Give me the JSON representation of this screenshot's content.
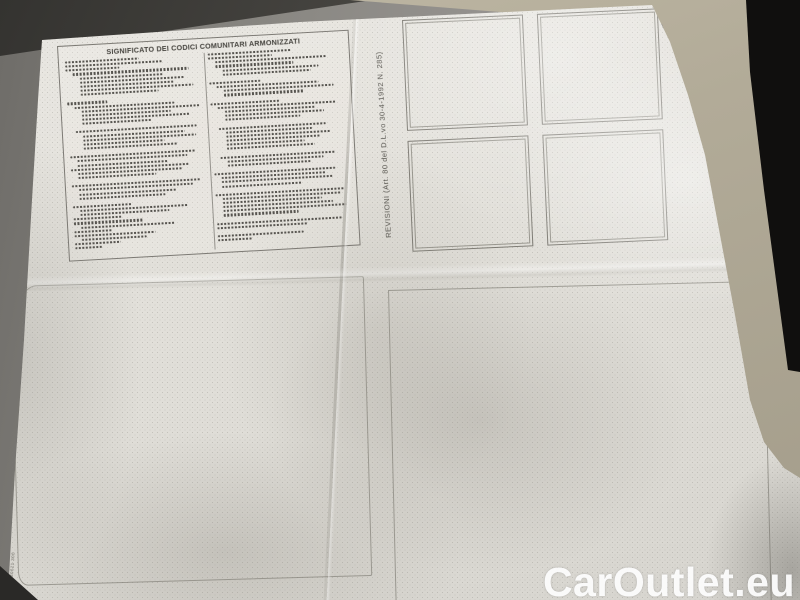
{
  "photo": {
    "watermark_text": "CarOutlet.eu"
  },
  "document": {
    "legend": {
      "title": "SIGNIFICATO DEI CODICI COMUNITARI ARMONIZZATI",
      "left_lines": [
        [
          0,
          55
        ],
        [
          0,
          72
        ],
        [
          0,
          40
        ],
        [
          1,
          86
        ],
        [
          2,
          62
        ],
        [
          2,
          78
        ],
        [
          2,
          70
        ],
        [
          2,
          84
        ],
        [
          2,
          58
        ],
        [
          0,
          0
        ],
        [
          0,
          30
        ],
        [
          1,
          74
        ],
        [
          2,
          88
        ],
        [
          2,
          66
        ],
        [
          2,
          80
        ],
        [
          2,
          52
        ],
        [
          0,
          0
        ],
        [
          1,
          90
        ],
        [
          2,
          76
        ],
        [
          2,
          84
        ],
        [
          2,
          60
        ],
        [
          2,
          70
        ],
        [
          0,
          0
        ],
        [
          0,
          94
        ],
        [
          1,
          82
        ],
        [
          1,
          68
        ],
        [
          0,
          88
        ],
        [
          1,
          77
        ],
        [
          1,
          58
        ],
        [
          0,
          0
        ],
        [
          0,
          96
        ],
        [
          1,
          85
        ],
        [
          1,
          72
        ],
        [
          1,
          64
        ],
        [
          0,
          0
        ],
        [
          0,
          44
        ],
        [
          1,
          80
        ],
        [
          1,
          66
        ],
        [
          0,
          36
        ],
        [
          0,
          52
        ],
        [
          1,
          70
        ],
        [
          0,
          28
        ],
        [
          0,
          60
        ],
        [
          1,
          48
        ],
        [
          0,
          34
        ],
        [
          0,
          20
        ]
      ],
      "right_lines": [
        [
          0,
          62
        ],
        [
          0,
          48
        ],
        [
          1,
          84
        ],
        [
          1,
          58
        ],
        [
          2,
          72
        ],
        [
          2,
          66
        ],
        [
          0,
          0
        ],
        [
          0,
          38
        ],
        [
          1,
          76
        ],
        [
          2,
          82
        ],
        [
          2,
          60
        ],
        [
          0,
          0
        ],
        [
          0,
          52
        ],
        [
          1,
          88
        ],
        [
          2,
          68
        ],
        [
          2,
          74
        ],
        [
          2,
          56
        ],
        [
          0,
          0
        ],
        [
          1,
          80
        ],
        [
          2,
          64
        ],
        [
          2,
          78
        ],
        [
          2,
          70
        ],
        [
          2,
          58
        ],
        [
          2,
          66
        ],
        [
          0,
          0
        ],
        [
          1,
          86
        ],
        [
          2,
          72
        ],
        [
          2,
          62
        ],
        [
          0,
          0
        ],
        [
          0,
          90
        ],
        [
          1,
          78
        ],
        [
          1,
          84
        ],
        [
          1,
          60
        ],
        [
          0,
          0
        ],
        [
          0,
          96
        ],
        [
          1,
          88
        ],
        [
          1,
          74
        ],
        [
          1,
          82
        ],
        [
          1,
          92
        ],
        [
          1,
          56
        ],
        [
          0,
          0
        ],
        [
          0,
          93
        ],
        [
          0,
          68
        ],
        [
          0,
          0
        ],
        [
          0,
          64
        ],
        [
          0,
          26
        ]
      ]
    },
    "revisioni": {
      "label": "REVISIONI  (Art. 80 del D.L.vo 30-4-1992 N. 285)",
      "stamp_boxes": 4
    },
    "edge_code": "A13 I 030621 306",
    "colors": {
      "paper": "#e2e0da",
      "surface_gray": "#8d8b86",
      "surface_beige": "#b2ab98",
      "ink": "#4a4844",
      "watermark": "#ffffff"
    }
  }
}
